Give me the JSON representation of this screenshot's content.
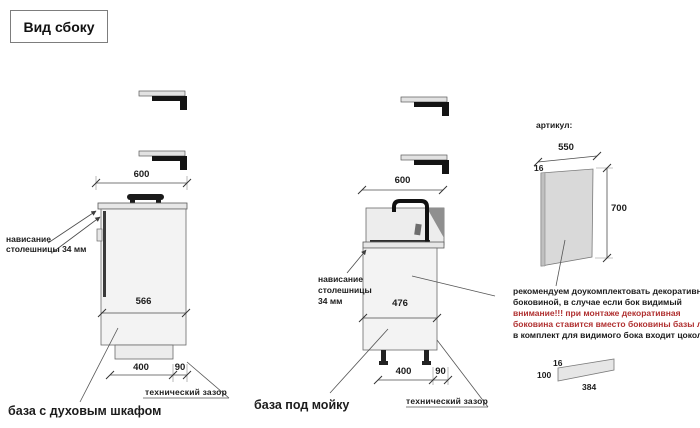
{
  "title": "Вид сбоку",
  "colors": {
    "accent_red": "#b03030",
    "line": "#4d4d4d",
    "fill_light": "#f3f3f3"
  },
  "left_cabinet": {
    "dim_top": "600",
    "dim_inner": "566",
    "dim_front": "400",
    "dim_back_gap": "90",
    "overhang_line1": "нависание",
    "overhang_line2": "столешницы 34 мм",
    "gap_label": "технический зазор",
    "caption": "база с духовым шкафом"
  },
  "sink_cabinet": {
    "dim_top": "600",
    "dim_inner": "476",
    "dim_front": "400",
    "dim_back_gap": "90",
    "overhang_line1": "нависание",
    "overhang_line2": "столешницы",
    "overhang_line3": "34 мм",
    "gap_label": "технический зазор",
    "caption": "база под мойку"
  },
  "side_panel": {
    "article_label": "артикул:",
    "dim_width": "550",
    "dim_thickness": "16",
    "dim_height": "700",
    "note_lines": [
      "рекомендуем доукомплектовать декоративной",
      "боковиной, в случае если бок видимый",
      "внимание!!! при монтаже декоративная",
      "боковина ставится вместо боковины базы лдсп",
      "в комплект для видимого бока входит цоколь:"
    ],
    "plinth": {
      "dim_thickness": "16",
      "dim_height": "100",
      "dim_length": "384"
    }
  }
}
